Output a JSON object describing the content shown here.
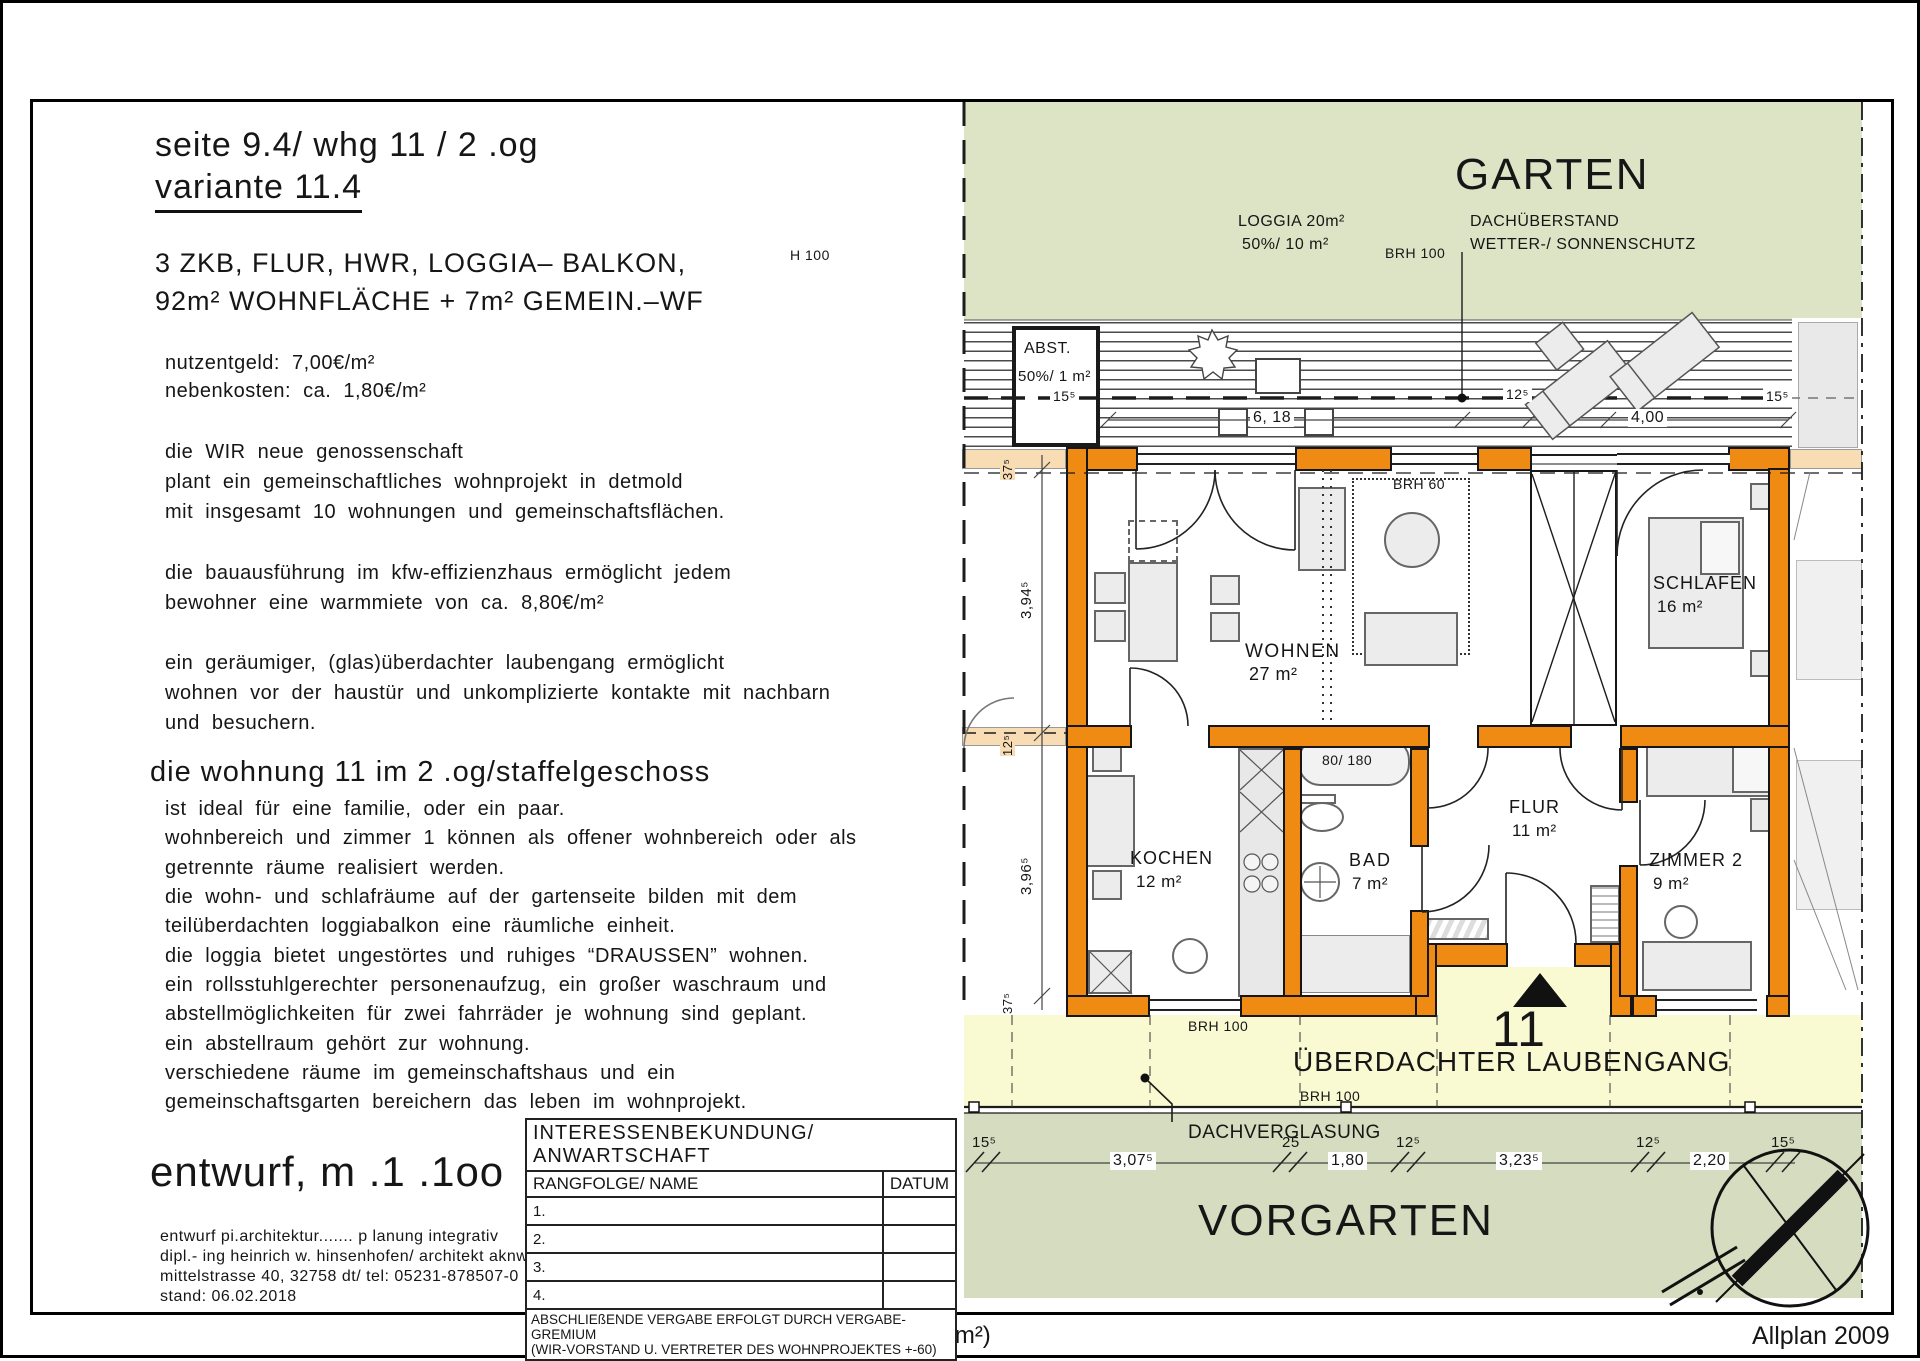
{
  "page": {
    "caption": "H/B = 210 / 297 (0.06m²)",
    "app": "Allplan 2009"
  },
  "panel": {
    "title_line1": "seite 9.4/ whg 11 / 2 .og",
    "title_line2": "variante 11.4",
    "subtitle_line1": "3 ZKB, FLUR, HWR, LOGGIA– BALKON,",
    "subtitle_line2": "92m² WOHNFLÄCHE + 7m² GEMEIN.–WF",
    "costs": [
      "nutzentgeld:  7,00€/m²",
      "nebenkosten:  ca. 1,80€/m²"
    ],
    "para1": [
      "die WIR neue genossenschaft",
      "plant ein gemeinschaftliches wohnprojekt in detmold",
      "mit insgesamt 10 wohnungen und gemeinschaftsflächen."
    ],
    "para2": [
      "die bauausführung im kfw-effizienzhaus ermöglicht jedem",
      "bewohner eine warmmiete von ca. 8,80€/m²"
    ],
    "para3": [
      "ein geräumiger, (glas)überdachter laubengang ermöglicht",
      "wohnen vor der haustür und unkomplizierte kontakte mit nachbarn",
      "und besuchern."
    ],
    "section_heading": "die wohnung 11 im 2 .og/staffelgeschoss",
    "para4": [
      "ist ideal für eine familie, oder ein paar.",
      "wohnbereich und zimmer 1 können als offener wohnbereich oder als",
      "getrennte räume realisiert werden.",
      "die wohn- und schlafräume auf der gartenseite bilden mit dem",
      "teilüberdachten loggiabalkon eine räumliche einheit.",
      "die loggia bietet ungestörtes und ruhiges “DRAUSSEN” wohnen.",
      "ein rollsstuhlgerechter personenaufzug, ein großer waschraum und",
      "abstellmöglichkeiten für zwei fahrräder je wohnung sind geplant.",
      "ein abstellraum gehört zur wohnung.",
      "verschiedene räume im gemeinschaftshaus und ein",
      "gemeinschaftsgarten bereichern das leben im wohnprojekt."
    ],
    "scale_note": "entwurf, m .1 .1oo",
    "credits": [
      "entwurf pi.architektur.......  p lanung  integrativ",
      "dipl.- ing heinrich w. hinsenhofen/ architekt aknw",
      "mittelstrasse 40, 32758 dt/ tel: 05231-878507-0",
      "stand: 06.02.2018"
    ]
  },
  "table": {
    "title": "INTERESSENBEKUNDUNG/ ANWARTSCHAFT",
    "col1": "RANGFOLGE/ NAME",
    "col2": "DATUM",
    "rows": [
      "1.",
      "2.",
      "3.",
      "4."
    ],
    "note1": "ABSCHLIEßENDE VERGABE ERFOLGT DURCH VERGABE-GREMIUM",
    "note2": "(WIR-VORSTAND U. VERTRETER DES WOHNPROJEKTES +-60)"
  },
  "plan": {
    "areas": {
      "garten": "GARTEN",
      "vorgarten": "VORGARTEN",
      "laubengang": "ÜBERDACHTER LAUBENGANG",
      "unit_number": "11",
      "dachverglasung": "DACHVERGLASUNG"
    },
    "labels": {
      "loggia1": "LOGGIA 20m²",
      "loggia2": "50%/ 10 m²",
      "dachueberstand1": "DACHÜBERSTAND",
      "dachueberstand2": "WETTER-/ SONNENSCHUTZ",
      "abst1": "ABST.",
      "abst2": "50%/ 1 m²",
      "brh100_left": "H 100",
      "brh100_right": "BRH 100",
      "brh100_bottom1": "BRH 100",
      "brh100_bottom2": "BRH 100",
      "brh60": "BRH 60",
      "tub": "80/ 180"
    },
    "rooms": {
      "wohnen": {
        "name": "WOHNEN",
        "size": "27 m²"
      },
      "schlafen": {
        "name": "SCHLAFEN",
        "size": "16 m²"
      },
      "kochen": {
        "name": "KOCHEN",
        "size": "12 m²"
      },
      "bad": {
        "name": "BAD",
        "size": "7 m²"
      },
      "flur": {
        "name": "FLUR",
        "size": "11 m²"
      },
      "zimmer2": {
        "name": "ZIMMER 2",
        "size": "9 m²"
      }
    },
    "dims": {
      "t1": "15⁵",
      "t2": "6, 18",
      "t3": "12⁵",
      "t4": "4,00",
      "t5": "15⁵",
      "l1": "37⁵",
      "l2": "3,94⁵",
      "l3": "12⁵",
      "l4": "3,96⁵",
      "l5": "37⁵",
      "b1": "15⁵",
      "b2": "3,07⁵",
      "b3": "25",
      "b4": "1,80",
      "b5": "12⁵",
      "b6": "3,23⁵",
      "b7": "12⁵",
      "b8": "2,20",
      "b9": "15⁵"
    },
    "colors": {
      "wall": "#ef8a12",
      "wall_pale": "#f7dcb4",
      "garten": "#dde3c5",
      "vorgarten": "#d6dcbf",
      "laubengang": "#f9f9d2"
    }
  }
}
